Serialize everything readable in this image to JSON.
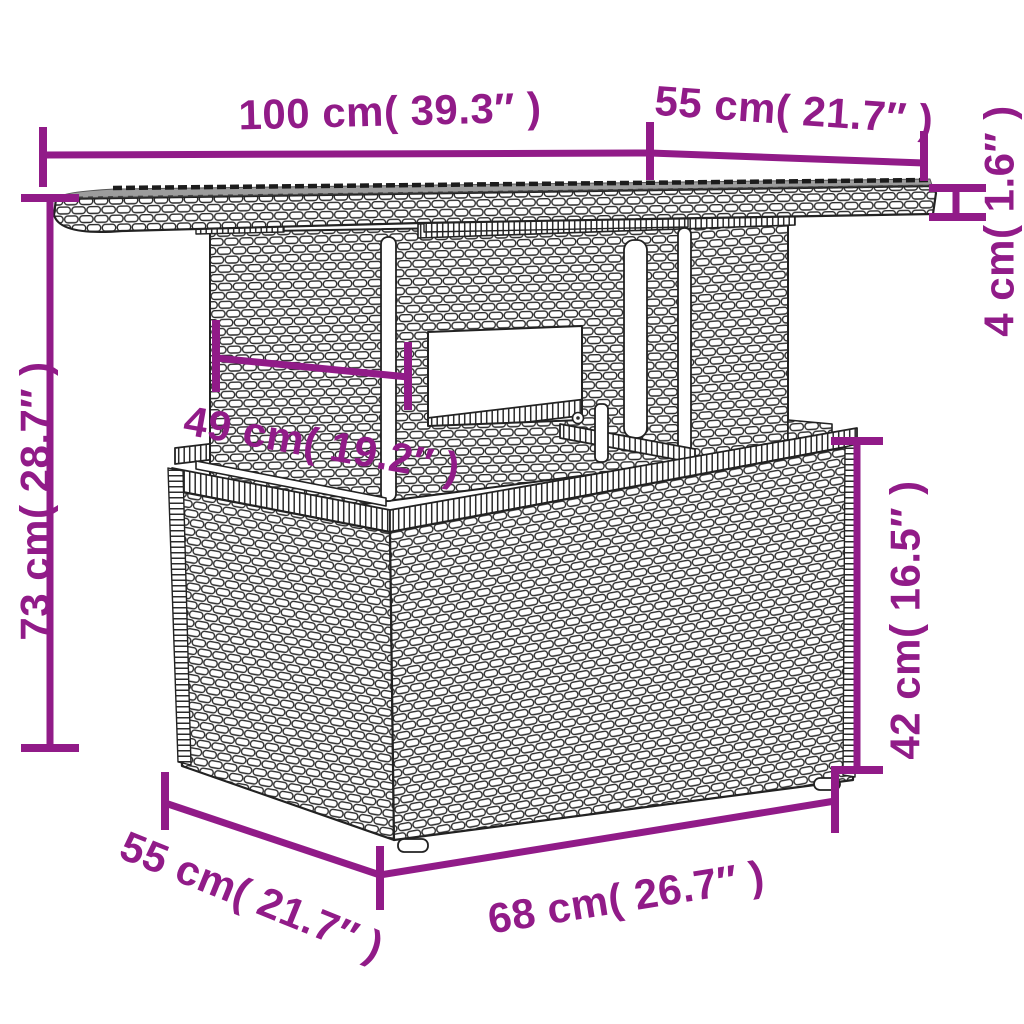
{
  "diagram": {
    "type": "product-dimension-diagram",
    "subject": "poly-rattan garden table with glass top",
    "colors": {
      "dimension": "#911B88",
      "outline": "#222222",
      "weave_stroke": "#2B2B2B",
      "glass": "#9C9C9C",
      "fill": "#FFFFFF"
    },
    "dimensions": [
      {
        "id": "tabletop-width",
        "cm": 100,
        "in": 39.3,
        "label": "100 cm( 39.3″ )"
      },
      {
        "id": "tabletop-depth",
        "cm": 55,
        "in": 21.7,
        "label": "55 cm( 21.7″ )"
      },
      {
        "id": "tabletop-thickness",
        "cm": 4,
        "in": 1.6,
        "label": "4 cm( 1.6″ )"
      },
      {
        "id": "total-height",
        "cm": 73,
        "in": 28.7,
        "label": "73 cm( 28.7″ )"
      },
      {
        "id": "pedestal-width",
        "cm": 49,
        "in": 19.2,
        "label": "49 cm( 19.2″ )"
      },
      {
        "id": "base-height",
        "cm": 42,
        "in": 16.5,
        "label": "42 cm( 16.5″ )"
      },
      {
        "id": "base-width",
        "cm": 68,
        "in": 26.7,
        "label": "68 cm( 26.7″ )"
      },
      {
        "id": "base-depth",
        "cm": 55,
        "in": 21.7,
        "label": "55 cm( 21.7″ )"
      }
    ]
  }
}
